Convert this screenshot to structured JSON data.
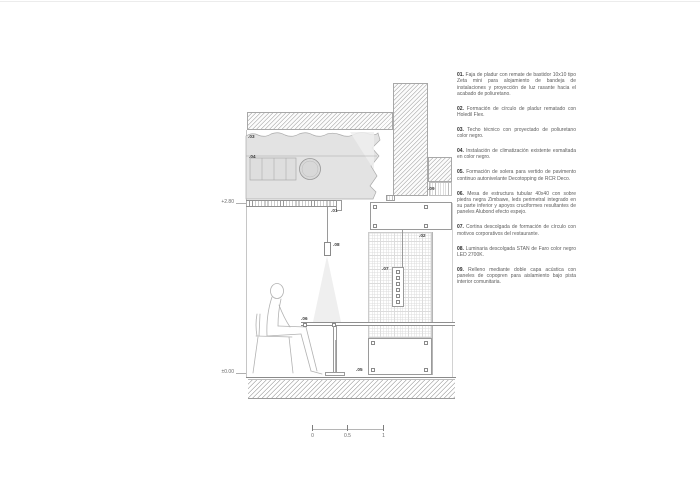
{
  "drawing": {
    "levels": {
      "ceiling": "+2.80",
      "floor": "±0.00"
    },
    "callouts": [
      {
        "label": ".01"
      },
      {
        "label": ".02"
      },
      {
        "label": ".03"
      },
      {
        "label": ".04"
      },
      {
        "label": ".05"
      },
      {
        "label": ".06"
      },
      {
        "label": ".07"
      },
      {
        "label": ".08"
      },
      {
        "label": ".09"
      }
    ],
    "scalebar": {
      "zero": "0",
      "half": "0.5",
      "one": "1"
    },
    "colors": {
      "hatch_line": "#b8b8b8",
      "foam_fill": "#e3e3e3",
      "drawing_line": "#9a9a9a",
      "grid_line": "#dcdcdc",
      "text": "#5c5c5c"
    }
  },
  "annotations": {
    "items": [
      {
        "num": "01.",
        "text": "Faja de pladur con remate de bastidor 10x10 tipo Zeta mini para alojamiento de bandeja de instalaciones y proyección de luz rasante hacia el acabado de poliuretano."
      },
      {
        "num": "02.",
        "text": "Formación de círculo de pladur rematado con Holedil Flex."
      },
      {
        "num": "03.",
        "text": "Techo técnico con proyectado de poliuretano color negro."
      },
      {
        "num": "04.",
        "text": "Instalación de climatización existente esmaltada en color negro."
      },
      {
        "num": "05.",
        "text": "Formación de solera para vertido de pavimento continuo autonivelante Decotopping de RCR Deco."
      },
      {
        "num": "06.",
        "text": "Mesa de estructura tubular 40x40 con sobre piedra negra Zimbawe, leds perimetral integrado en su parte inferior y apoyos cruciformes resultantes de paneles Alubond efecto espejo."
      },
      {
        "num": "07.",
        "text": "Cortina descolgada de formación de círculo con motivos corporativos del restaurante."
      },
      {
        "num": "08.",
        "text": "Luminaria descolgada STAN de Faro color negro LED 2700K."
      },
      {
        "num": "09.",
        "text": "Relleno mediante doble capa acústica con paneles de copopren para aislamiento bajo pista interior comunitaria."
      }
    ]
  }
}
